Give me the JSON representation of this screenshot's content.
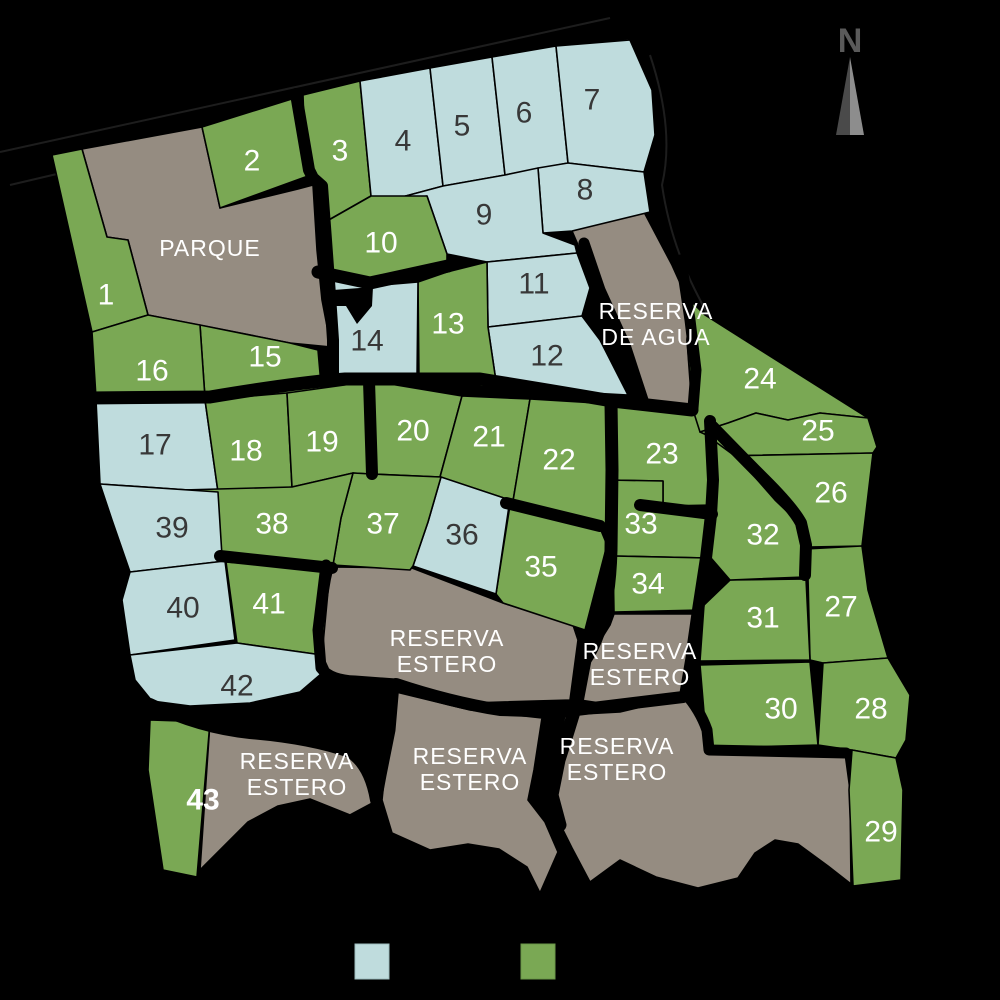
{
  "compass": {
    "label": "N"
  },
  "palette": {
    "lot_blue": "#bfdcdd",
    "lot_green": "#7aa854",
    "reserve_gray": "#958c81",
    "road_black": "#000000",
    "label_light": "#ffffff",
    "label_dark": "#383838",
    "compass_dark": "#4a4a4a",
    "compass_light": "#8d8d8d"
  },
  "legend": {
    "swatches": [
      {
        "name": "legend-swatch-blue",
        "color": "#bfdcdd"
      },
      {
        "name": "legend-swatch-green",
        "color": "#7aa854"
      }
    ]
  },
  "lots": [
    {
      "number": "1",
      "status": "green"
    },
    {
      "number": "2",
      "status": "green"
    },
    {
      "number": "3",
      "status": "green"
    },
    {
      "number": "4",
      "status": "blue"
    },
    {
      "number": "5",
      "status": "blue"
    },
    {
      "number": "6",
      "status": "blue"
    },
    {
      "number": "7",
      "status": "blue"
    },
    {
      "number": "8",
      "status": "blue"
    },
    {
      "number": "9",
      "status": "blue"
    },
    {
      "number": "10",
      "status": "green"
    },
    {
      "number": "11",
      "status": "blue"
    },
    {
      "number": "12",
      "status": "blue"
    },
    {
      "number": "13",
      "status": "green"
    },
    {
      "number": "14",
      "status": "blue"
    },
    {
      "number": "15",
      "status": "green"
    },
    {
      "number": "16",
      "status": "green"
    },
    {
      "number": "17",
      "status": "blue"
    },
    {
      "number": "18",
      "status": "green"
    },
    {
      "number": "19",
      "status": "green"
    },
    {
      "number": "20",
      "status": "green"
    },
    {
      "number": "21",
      "status": "green"
    },
    {
      "number": "22",
      "status": "green"
    },
    {
      "number": "23",
      "status": "green"
    },
    {
      "number": "24",
      "status": "green"
    },
    {
      "number": "25",
      "status": "green"
    },
    {
      "number": "26",
      "status": "green"
    },
    {
      "number": "27",
      "status": "green"
    },
    {
      "number": "28",
      "status": "green"
    },
    {
      "number": "29",
      "status": "green"
    },
    {
      "number": "30",
      "status": "green"
    },
    {
      "number": "31",
      "status": "green"
    },
    {
      "number": "32",
      "status": "green"
    },
    {
      "number": "33",
      "status": "green"
    },
    {
      "number": "34",
      "status": "green"
    },
    {
      "number": "35",
      "status": "green"
    },
    {
      "number": "36",
      "status": "blue"
    },
    {
      "number": "37",
      "status": "green"
    },
    {
      "number": "38",
      "status": "green"
    },
    {
      "number": "39",
      "status": "blue"
    },
    {
      "number": "40",
      "status": "blue"
    },
    {
      "number": "41",
      "status": "green"
    },
    {
      "number": "42",
      "status": "blue"
    },
    {
      "number": "43",
      "status": "green"
    }
  ],
  "reserves": [
    {
      "name": "parque",
      "lines": [
        "PARQUE",
        ""
      ]
    },
    {
      "name": "reserva-de-agua",
      "lines": [
        "RESERVA",
        "DE AGUA"
      ]
    },
    {
      "name": "reserva-estero-center",
      "lines": [
        "RESERVA",
        "ESTERO"
      ]
    },
    {
      "name": "reserva-estero-right",
      "lines": [
        "RESERVA",
        "ESTERO"
      ]
    },
    {
      "name": "reserva-estero-bottom-left",
      "lines": [
        "RESERVA",
        "ESTERO"
      ]
    },
    {
      "name": "reserva-estero-bottom-middle",
      "lines": [
        "RESERVA",
        "ESTERO"
      ]
    },
    {
      "name": "reserva-estero-bottom-right",
      "lines": [
        "RESERVA",
        "ESTERO"
      ]
    }
  ]
}
